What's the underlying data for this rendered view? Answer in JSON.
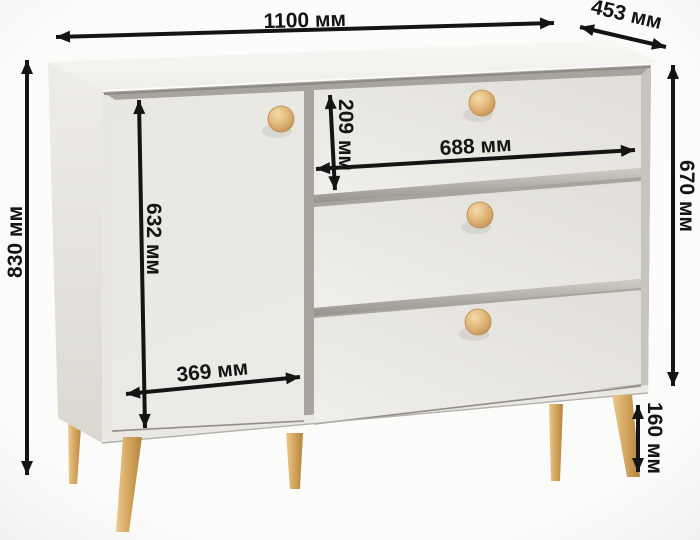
{
  "diagram": {
    "unit": "мм",
    "dimensions": {
      "overall_width": {
        "value": 1100,
        "label": "1100 мм"
      },
      "depth": {
        "value": 453,
        "label": "453 мм"
      },
      "overall_height": {
        "value": 830,
        "label": "830 мм"
      },
      "body_height": {
        "value": 670,
        "label": "670 мм"
      },
      "door_height": {
        "value": 632,
        "label": "632 мм"
      },
      "top_drawer_height": {
        "value": 209,
        "label": "209 мм"
      },
      "drawer_width": {
        "value": 688,
        "label": "688 мм"
      },
      "door_width": {
        "value": 369,
        "label": "369 мм"
      },
      "leg_height": {
        "value": 160,
        "label": "160 мм"
      }
    },
    "colors": {
      "background": "#fcfcfb",
      "body_front": "#eae8e3",
      "body_top": "#f6f5f2",
      "body_side": "#e3e0da",
      "gap_shadow": "#a7a49d",
      "wood_knob_leg": "#dcae6a",
      "annotation": "#141414"
    }
  }
}
